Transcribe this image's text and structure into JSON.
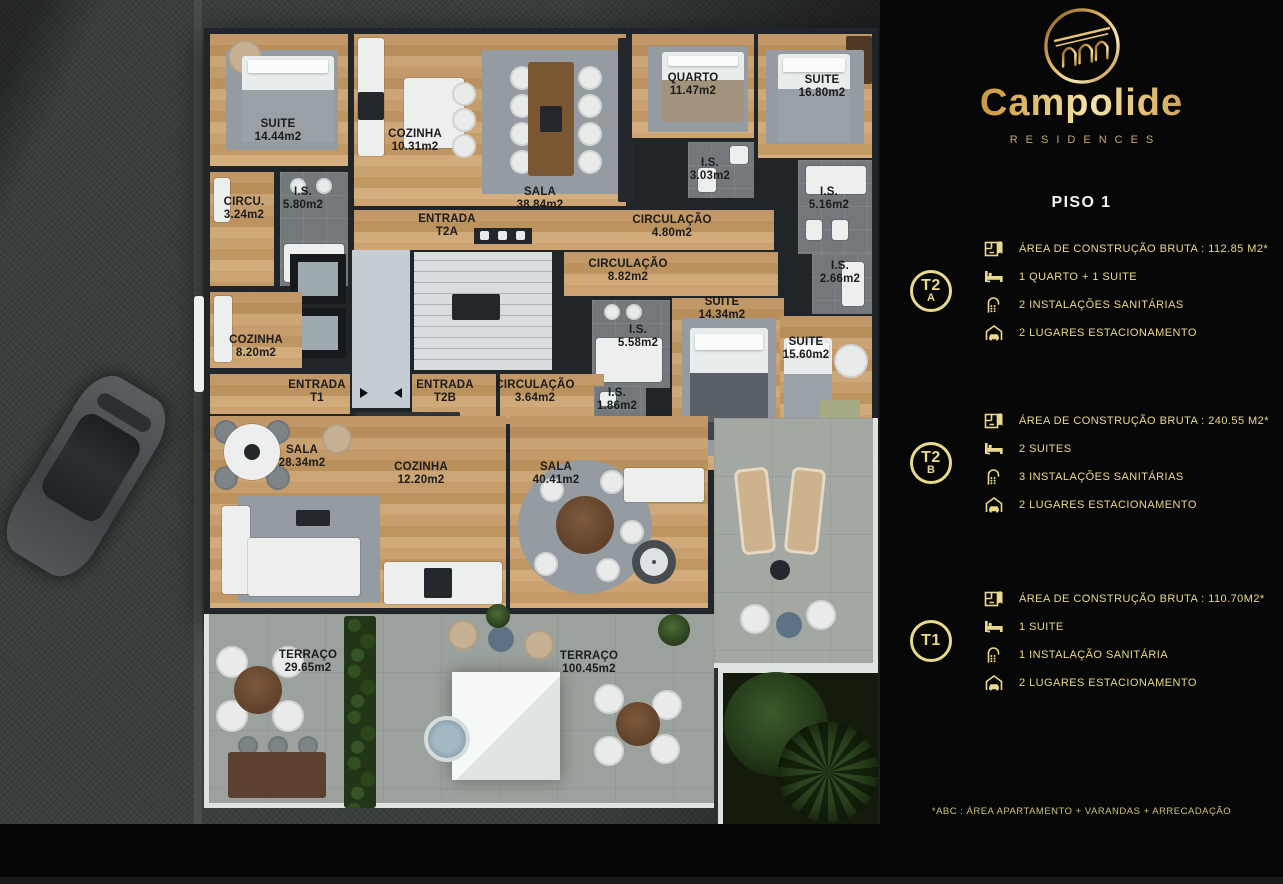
{
  "brand": {
    "name": "Campolide",
    "tagline": "RESIDENCES"
  },
  "page": {
    "title": "PISO 1",
    "footnote": "*ABC :  ÁREA APARTAMENTO + VARANDAS + ARRECADAÇÃO"
  },
  "colors": {
    "gold": "#e9d98e",
    "gold_deep": "#a4762c",
    "panel_bg": "#070707",
    "wood_floor": "#c89e6b",
    "walls": "#20252a",
    "concrete": "#9ba19c",
    "garden": "#141b0d",
    "label_text": "#1b1b1b"
  },
  "units": [
    {
      "id": "T2A",
      "badge_line1": "T2",
      "badge_line2": "A",
      "specs": [
        {
          "icon": "floorplan-icon",
          "text": "ÁREA DE CONSTRUÇÃO BRUTA :  112.85 M2*"
        },
        {
          "icon": "bed-icon",
          "text": "1 QUARTO + 1 SUITE"
        },
        {
          "icon": "shower-icon",
          "text": "2 INSTALAÇÕES SANITÁRIAS"
        },
        {
          "icon": "garage-icon",
          "text": "2 LUGARES ESTACIONAMENTO"
        }
      ]
    },
    {
      "id": "T2B",
      "badge_line1": "T2",
      "badge_line2": "B",
      "specs": [
        {
          "icon": "floorplan-icon",
          "text": "ÁREA DE CONSTRUÇÃO BRUTA :  240.55 M2*"
        },
        {
          "icon": "bed-icon",
          "text": "2 SUITES"
        },
        {
          "icon": "shower-icon",
          "text": "3 INSTALAÇÕES SANITÁRIAS"
        },
        {
          "icon": "garage-icon",
          "text": "2 LUGARES ESTACIONAMENTO"
        }
      ]
    },
    {
      "id": "T1",
      "badge_line1": "T1",
      "badge_line2": "",
      "specs": [
        {
          "icon": "floorplan-icon",
          "text": "ÁREA DE CONSTRUÇÃO BRUTA :  110.70M2*"
        },
        {
          "icon": "bed-icon",
          "text": "1 SUITE"
        },
        {
          "icon": "shower-icon",
          "text": "1 INSTALAÇÃO SANITÁRIA"
        },
        {
          "icon": "garage-icon",
          "text": "2 LUGARES ESTACIONAMENTO"
        }
      ]
    }
  ],
  "floorplan": {
    "rooms": [
      {
        "name": "SUITE",
        "area": "14.44m2"
      },
      {
        "name": "COZINHA",
        "area": "10.31m2"
      },
      {
        "name": "SALA",
        "area": "38.84m2"
      },
      {
        "name": "QUARTO",
        "area": "11.47m2"
      },
      {
        "name": "SUITE",
        "area": "16.80m2"
      },
      {
        "name": "I.S.",
        "area": "5.80m2"
      },
      {
        "name": "CIRCU.",
        "area": "3.24m2"
      },
      {
        "name": "ENTRADA",
        "area": "T2A"
      },
      {
        "name": "CIRCULAÇÃO",
        "area": "4.80m2"
      },
      {
        "name": "I.S.",
        "area": "3.03m2"
      },
      {
        "name": "I.S.",
        "area": "5.16m2"
      },
      {
        "name": "CIRCULAÇÃO",
        "area": "8.82m2"
      },
      {
        "name": "I.S.",
        "area": "2.66m2"
      },
      {
        "name": "SUITE",
        "area": "14.34m2"
      },
      {
        "name": "I.S.",
        "area": "5.58m2"
      },
      {
        "name": "SUITE",
        "area": "15.60m2"
      },
      {
        "name": "COZINHA",
        "area": "8.20m2"
      },
      {
        "name": "ENTRADA",
        "area": "T1"
      },
      {
        "name": "ENTRADA",
        "area": "T2B"
      },
      {
        "name": "CIRCULAÇÃO",
        "area": "3.64m2"
      },
      {
        "name": "I.S.",
        "area": "1.86m2"
      },
      {
        "name": "SALA",
        "area": "28.34m2"
      },
      {
        "name": "COZINHA",
        "area": "12.20m2"
      },
      {
        "name": "SALA",
        "area": "40.41m2"
      },
      {
        "name": "TERRAÇO",
        "area": "29.65m2"
      },
      {
        "name": "TERRAÇO",
        "area": "100.45m2"
      }
    ]
  }
}
